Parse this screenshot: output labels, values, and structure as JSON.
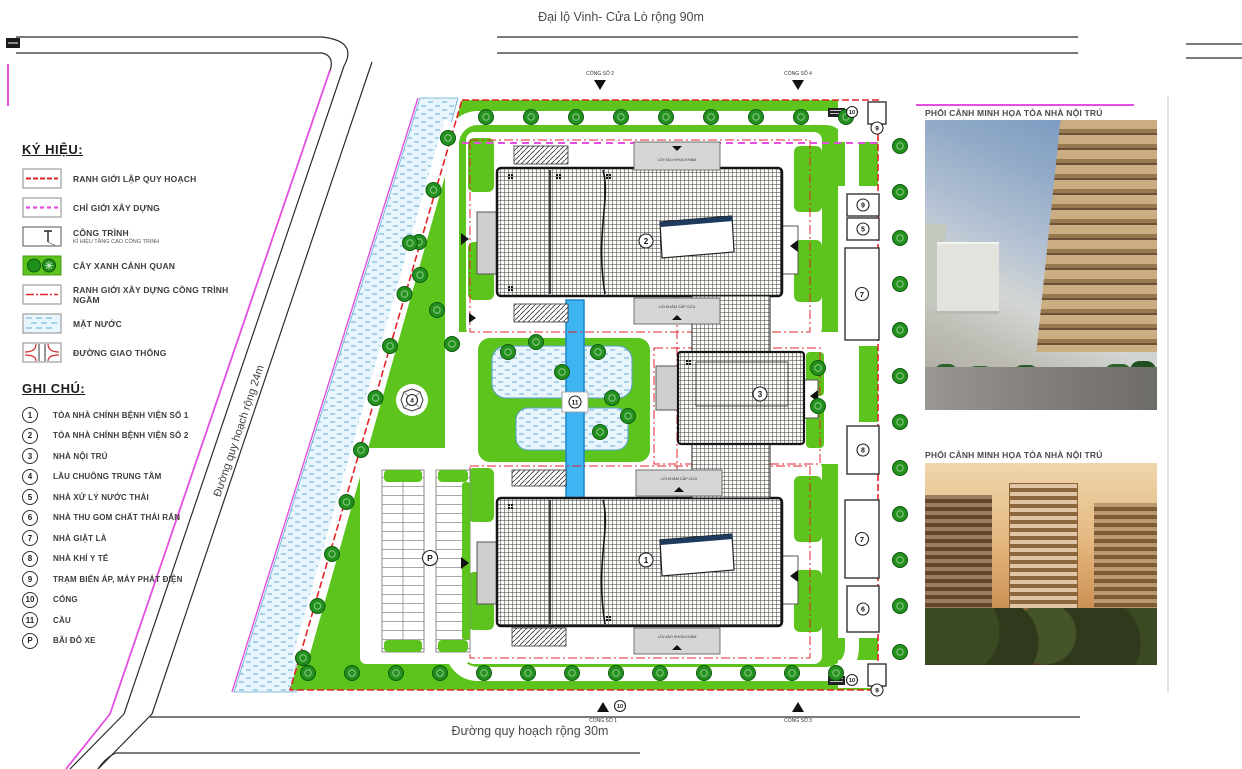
{
  "labels": {
    "top_road": "Đại lộ Vinh- Cửa Lò rộng 90m",
    "bottom_road": "Đường quy hoạch rộng 30m",
    "left_road": "Đường quy hoạch rộng 24m"
  },
  "legend": {
    "heading": "KÝ HIỆU:",
    "items": [
      {
        "label": "RANH GIỚI LẬP QUY HOẠCH"
      },
      {
        "label": "CHỈ GIỚI XÂY DỰNG"
      },
      {
        "label": "CÔNG TRÌNH",
        "subnote": "KÍ HIỆU TẦNG CAO CÔNG TRÌNH"
      },
      {
        "label": "CÂY XANH CẢNH QUAN"
      },
      {
        "label": "RANH GIỚI XÂY DỰNG CÔNG TRÌNH NGẦM"
      },
      {
        "label": "MẶT NƯỚC"
      },
      {
        "label": "ĐƯỜNG GIAO THÔNG"
      }
    ]
  },
  "notes": {
    "heading": "GHI CHÚ:",
    "items": [
      {
        "num": "1",
        "label": "TÒA NHÀ CHÍNH BỆNH VIỆN SỐ 1"
      },
      {
        "num": "2",
        "label": "TÒA NHÀ CHÍNH BỆNH VIỆN SỐ 2"
      },
      {
        "num": "3",
        "label": "NHÀ NỘI TRÚ"
      },
      {
        "num": "4",
        "label": "LẦU CHUÔNG TRUNG TÂM"
      },
      {
        "num": "5",
        "label": "NHÀ XỬ LÝ NƯỚC THẢI"
      },
      {
        "num": "6",
        "label": "NHÀ THU GOM CHẤT THẢI RẮN"
      },
      {
        "num": "7",
        "label": "NHÀ GIẶT LÀ"
      },
      {
        "num": "8",
        "label": "NHÀ KHÍ Y TẾ"
      },
      {
        "num": "9",
        "label": "TRẠM BIẾN ÁP, MÁY PHÁT ĐIỆN"
      },
      {
        "num": "10",
        "label": "CỔNG"
      },
      {
        "num": "11",
        "label": "CẦU"
      },
      {
        "num": "P",
        "label": "BÃI ĐỖ XE"
      }
    ]
  },
  "gates": {
    "top_left": "CỔNG SỐ 2",
    "top_right": "CỔNG SỐ 4",
    "bottom_left": "CỔNG SỐ 1",
    "bottom_right": "CỔNG SỐ 3"
  },
  "renders": {
    "caption_1": "PHỐI CẢNH MINH HỌA TÒA NHÀ NỘI TRÚ",
    "caption_2": "PHỐI CẢNH MINH HỌA TÒA NHÀ NỘI TRÚ"
  },
  "markers": {
    "b1": "1",
    "b2": "2",
    "b3": "3",
    "tower": "4",
    "wwt": "5",
    "waste": "6",
    "laundry": "7",
    "gas": "8",
    "power": "9",
    "gate": "10",
    "bridge": "11",
    "parking": "P"
  },
  "entries": {
    "main_top": "LỐI VÀO KHOA KHÁM",
    "main_top_inner": "LỐI KHÁM CẤP CỨU",
    "main_bottom_inner": "LỐI KHÁM CẤP CỨU",
    "main_bottom": "LỐI VÀO KHOA KHÁM"
  },
  "colors": {
    "boundary_red": "#e02328",
    "build_line_magenta": "#e44fe0",
    "lawn_green": "#5cc41d",
    "tree_green": "#22911d",
    "water_blue": "#e9f5fc",
    "canal_blue": "#3fb4f2"
  }
}
